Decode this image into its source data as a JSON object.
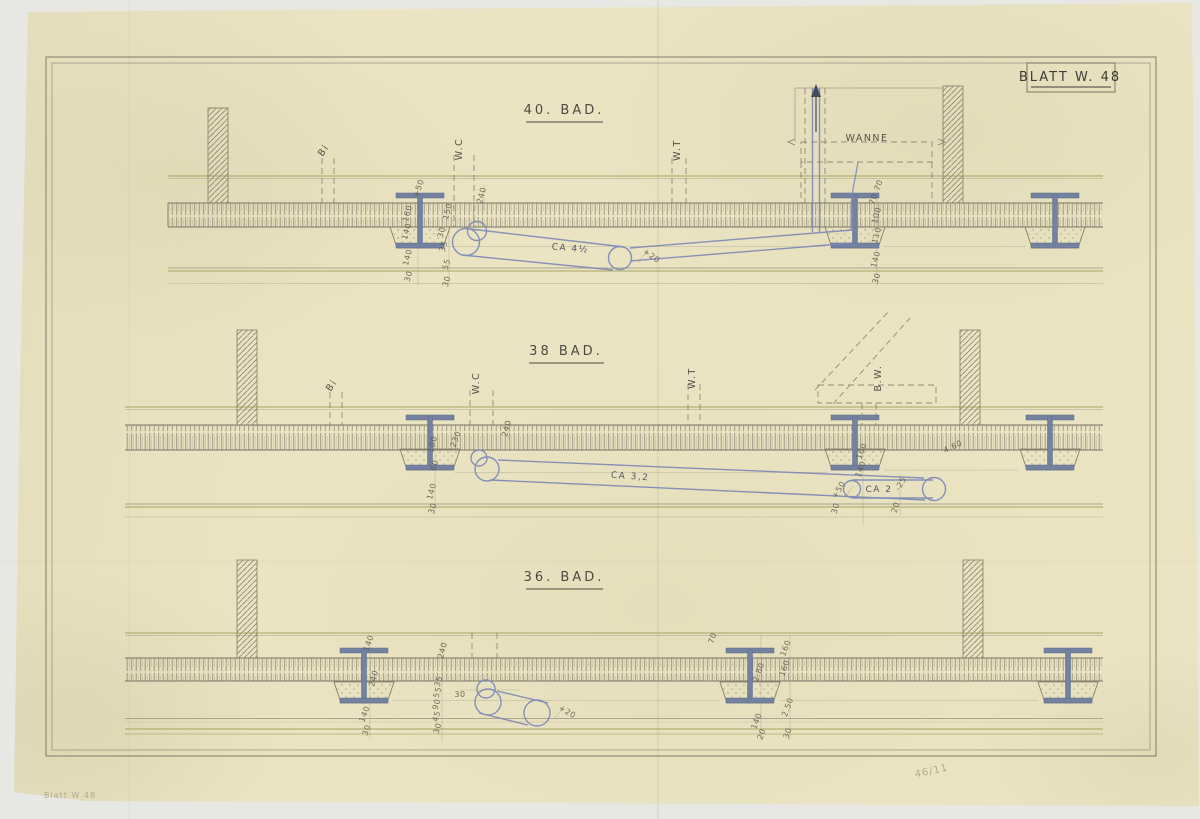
{
  "sheet_label": {
    "text": "BLATT W. 48"
  },
  "sections": [
    {
      "title": "40. BAD."
    },
    {
      "title": "38 BAD."
    },
    {
      "title": "36. BAD."
    }
  ],
  "colors": {
    "paper": "#eae4c2",
    "pencil": "#827d6a",
    "olive_line": "#999c52",
    "ink_blue": "#7b87b8",
    "beam_fill": "#74819f",
    "graphite_text": "#57524a"
  },
  "annotations": [
    {
      "t": "Bi",
      "x": 326,
      "y": 152,
      "r": -55,
      "c": "lbl"
    },
    {
      "t": "W.C",
      "x": 462,
      "y": 149,
      "r": -90,
      "c": "lbl"
    },
    {
      "t": "W.T",
      "x": 680,
      "y": 150,
      "r": -90,
      "c": "lbl"
    },
    {
      "t": "WANNE",
      "x": 867,
      "y": 141,
      "r": 0,
      "c": "lbl"
    },
    {
      "t": "CA 4½",
      "x": 570,
      "y": 251,
      "r": 5,
      "c": "pipe"
    },
    {
      "t": "+20",
      "x": 650,
      "y": 258,
      "r": 35,
      "c": "dim"
    },
    {
      "t": "+50",
      "x": 421,
      "y": 189,
      "r": -70,
      "c": "dim"
    },
    {
      "t": "240",
      "x": 484,
      "y": 196,
      "r": -75,
      "c": "dim"
    },
    {
      "t": "150",
      "x": 450,
      "y": 212,
      "r": -75,
      "c": "dim"
    },
    {
      "t": "160",
      "x": 410,
      "y": 214,
      "r": -75,
      "c": "dim"
    },
    {
      "t": "140",
      "x": 409,
      "y": 232,
      "r": -75,
      "c": "dim"
    },
    {
      "t": "140",
      "x": 410,
      "y": 258,
      "r": -75,
      "c": "dim"
    },
    {
      "t": "30",
      "x": 411,
      "y": 277,
      "r": -75,
      "c": "dim"
    },
    {
      "t": "30",
      "x": 444,
      "y": 233,
      "r": -75,
      "c": "dim"
    },
    {
      "t": "35",
      "x": 446,
      "y": 247,
      "r": -75,
      "c": "dim"
    },
    {
      "t": "55",
      "x": 449,
      "y": 265,
      "r": -75,
      "c": "dim"
    },
    {
      "t": "30",
      "x": 449,
      "y": 282,
      "r": -75,
      "c": "dim"
    },
    {
      "t": "70",
      "x": 881,
      "y": 186,
      "r": -70,
      "c": "dim"
    },
    {
      "t": "70",
      "x": 876,
      "y": 200,
      "r": -70,
      "c": "dim"
    },
    {
      "t": "100",
      "x": 879,
      "y": 216,
      "r": -75,
      "c": "dim"
    },
    {
      "t": "110",
      "x": 879,
      "y": 236,
      "r": -75,
      "c": "dim"
    },
    {
      "t": "140",
      "x": 878,
      "y": 260,
      "r": -75,
      "c": "dim"
    },
    {
      "t": "30",
      "x": 879,
      "y": 279,
      "r": -75,
      "c": "dim"
    },
    {
      "t": "Bi",
      "x": 334,
      "y": 387,
      "r": -55,
      "c": "lbl"
    },
    {
      "t": "W.C",
      "x": 479,
      "y": 383,
      "r": -90,
      "c": "lbl"
    },
    {
      "t": "W.T",
      "x": 695,
      "y": 378,
      "r": -90,
      "c": "lbl"
    },
    {
      "t": "B.W.",
      "x": 881,
      "y": 378,
      "r": -90,
      "c": "lbl"
    },
    {
      "t": "CA 3,2",
      "x": 630,
      "y": 479,
      "r": 4,
      "c": "pipe"
    },
    {
      "t": "CA 2",
      "x": 879,
      "y": 492,
      "r": 0,
      "c": "pipe"
    },
    {
      "t": "+50",
      "x": 841,
      "y": 491,
      "r": -60,
      "c": "dim"
    },
    {
      "t": "-25",
      "x": 903,
      "y": 485,
      "r": -60,
      "c": "dim"
    },
    {
      "t": "240",
      "x": 509,
      "y": 429,
      "r": -75,
      "c": "dim"
    },
    {
      "t": "230",
      "x": 458,
      "y": 440,
      "r": -70,
      "c": "dim"
    },
    {
      "t": "100",
      "x": 435,
      "y": 445,
      "r": -75,
      "c": "dim"
    },
    {
      "t": "60",
      "x": 437,
      "y": 466,
      "r": -75,
      "c": "dim"
    },
    {
      "t": "140",
      "x": 434,
      "y": 492,
      "r": -75,
      "c": "dim"
    },
    {
      "t": "30",
      "x": 435,
      "y": 509,
      "r": -75,
      "c": "dim"
    },
    {
      "t": "160",
      "x": 864,
      "y": 452,
      "r": -70,
      "c": "dim"
    },
    {
      "t": "140",
      "x": 863,
      "y": 470,
      "r": -70,
      "c": "dim"
    },
    {
      "t": "4.60",
      "x": 954,
      "y": 449,
      "r": -25,
      "c": "dim"
    },
    {
      "t": "30",
      "x": 838,
      "y": 509,
      "r": -75,
      "c": "dim"
    },
    {
      "t": "20",
      "x": 898,
      "y": 508,
      "r": -75,
      "c": "dim"
    },
    {
      "t": "30",
      "x": 460,
      "y": 697,
      "r": 0,
      "c": "dim"
    },
    {
      "t": "+20",
      "x": 566,
      "y": 714,
      "r": 30,
      "c": "dim"
    },
    {
      "t": "240",
      "x": 445,
      "y": 651,
      "r": -75,
      "c": "dim"
    },
    {
      "t": "35",
      "x": 441,
      "y": 682,
      "r": -75,
      "c": "dim"
    },
    {
      "t": "55",
      "x": 440,
      "y": 693,
      "r": -75,
      "c": "dim"
    },
    {
      "t": "90",
      "x": 439,
      "y": 705,
      "r": -75,
      "c": "dim"
    },
    {
      "t": "45",
      "x": 439,
      "y": 717,
      "r": -75,
      "c": "dim"
    },
    {
      "t": "30",
      "x": 440,
      "y": 729,
      "r": -75,
      "c": "dim"
    },
    {
      "t": "140",
      "x": 371,
      "y": 644,
      "r": -70,
      "c": "dim"
    },
    {
      "t": "240",
      "x": 376,
      "y": 679,
      "r": -75,
      "c": "dim"
    },
    {
      "t": "140",
      "x": 367,
      "y": 715,
      "r": -70,
      "c": "dim"
    },
    {
      "t": "30",
      "x": 369,
      "y": 731,
      "r": -70,
      "c": "dim"
    },
    {
      "t": "70",
      "x": 715,
      "y": 639,
      "r": -70,
      "c": "dim"
    },
    {
      "t": "160",
      "x": 788,
      "y": 649,
      "r": -70,
      "c": "dim"
    },
    {
      "t": "160",
      "x": 787,
      "y": 669,
      "r": -70,
      "c": "dim"
    },
    {
      "t": "2.80",
      "x": 761,
      "y": 673,
      "r": -70,
      "c": "dim"
    },
    {
      "t": "2.50",
      "x": 790,
      "y": 708,
      "r": -70,
      "c": "dim"
    },
    {
      "t": "140",
      "x": 759,
      "y": 722,
      "r": -70,
      "c": "dim"
    },
    {
      "t": "30",
      "x": 790,
      "y": 734,
      "r": -70,
      "c": "dim"
    },
    {
      "t": "20",
      "x": 764,
      "y": 735,
      "r": -70,
      "c": "dim"
    },
    {
      "t": "Blatt W 48",
      "x": 70,
      "y": 798,
      "r": 0,
      "c": "faint"
    },
    {
      "t": "46/11",
      "x": 932,
      "y": 774,
      "r": -12,
      "c": "faint2"
    }
  ]
}
